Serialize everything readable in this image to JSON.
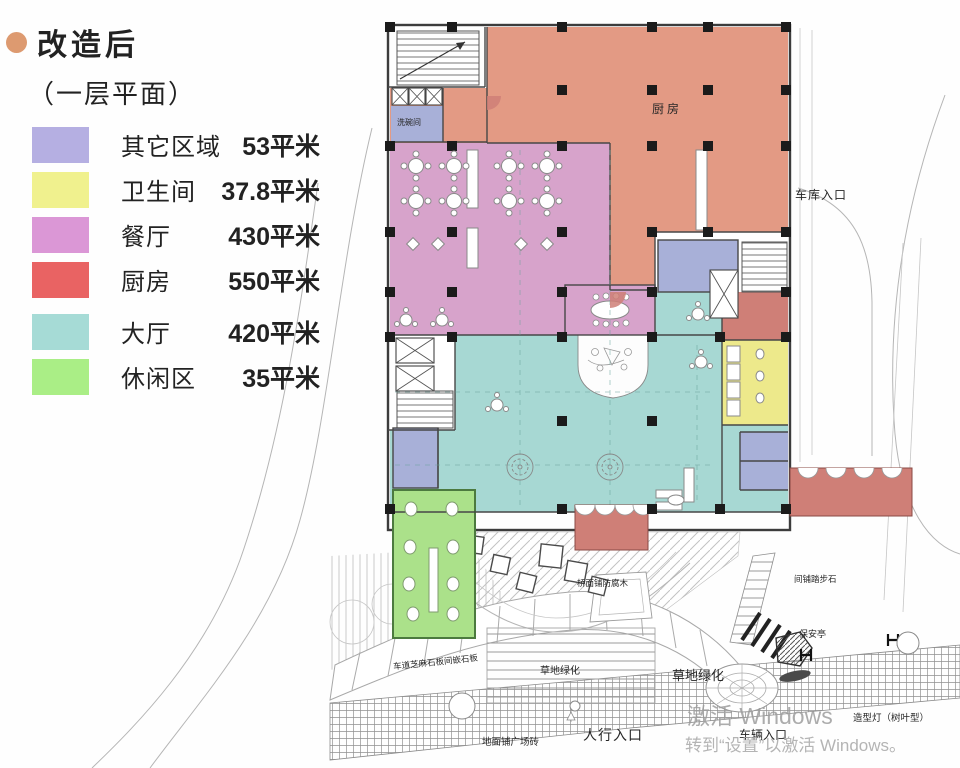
{
  "header": {
    "bullet_color": "#dd9a70",
    "title": "改造后",
    "subtitle": "（一层平面）"
  },
  "legend": {
    "items": [
      {
        "label": "其它区域",
        "value": "53平米",
        "color": "#b5afe2"
      },
      {
        "label": "卫生间",
        "value": "37.8平米",
        "color": "#f0f18e"
      },
      {
        "label": "餐厅",
        "value": "430平米",
        "color": "#db97d6"
      },
      {
        "label": "厨房",
        "value": "550平米",
        "color": "#e96363"
      },
      {
        "label": "大厅",
        "value": "420平米",
        "color": "#a6dbd6"
      },
      {
        "label": "休闲区",
        "value": "35平米",
        "color": "#aaee86"
      }
    ]
  },
  "plan": {
    "colors": {
      "kitchen": "#e39a84",
      "dining": "#d7a3cb",
      "hall": "#a7d8d3",
      "bathroom": "#ede98b",
      "leisure": "#abe18a",
      "other": "#a8b0d8",
      "entrance": "#cf7f77"
    },
    "rooms": {
      "kitchen": "厨房",
      "dishwashing": "洗碗间"
    },
    "site": {
      "garage_entrance": "车库入口",
      "bridge_deck": "桥面铺防腐木",
      "driveway_paving": "车道芝麻石板间嵌石板",
      "grass_1": "草地绿化",
      "grass_2": "草地绿化",
      "pedestrian_entrance": "人行入口",
      "plaza_paving": "地面铺广场砖",
      "vehicle_entrance": "车辆入口",
      "security_booth": "保安亭",
      "stepping_stones": "间铺踏步石",
      "shaped_tree": "造型灯（树叶型）"
    }
  },
  "watermark": {
    "line1": "激活 Windows",
    "line2": "转到“设置”以激活 Windows。"
  }
}
